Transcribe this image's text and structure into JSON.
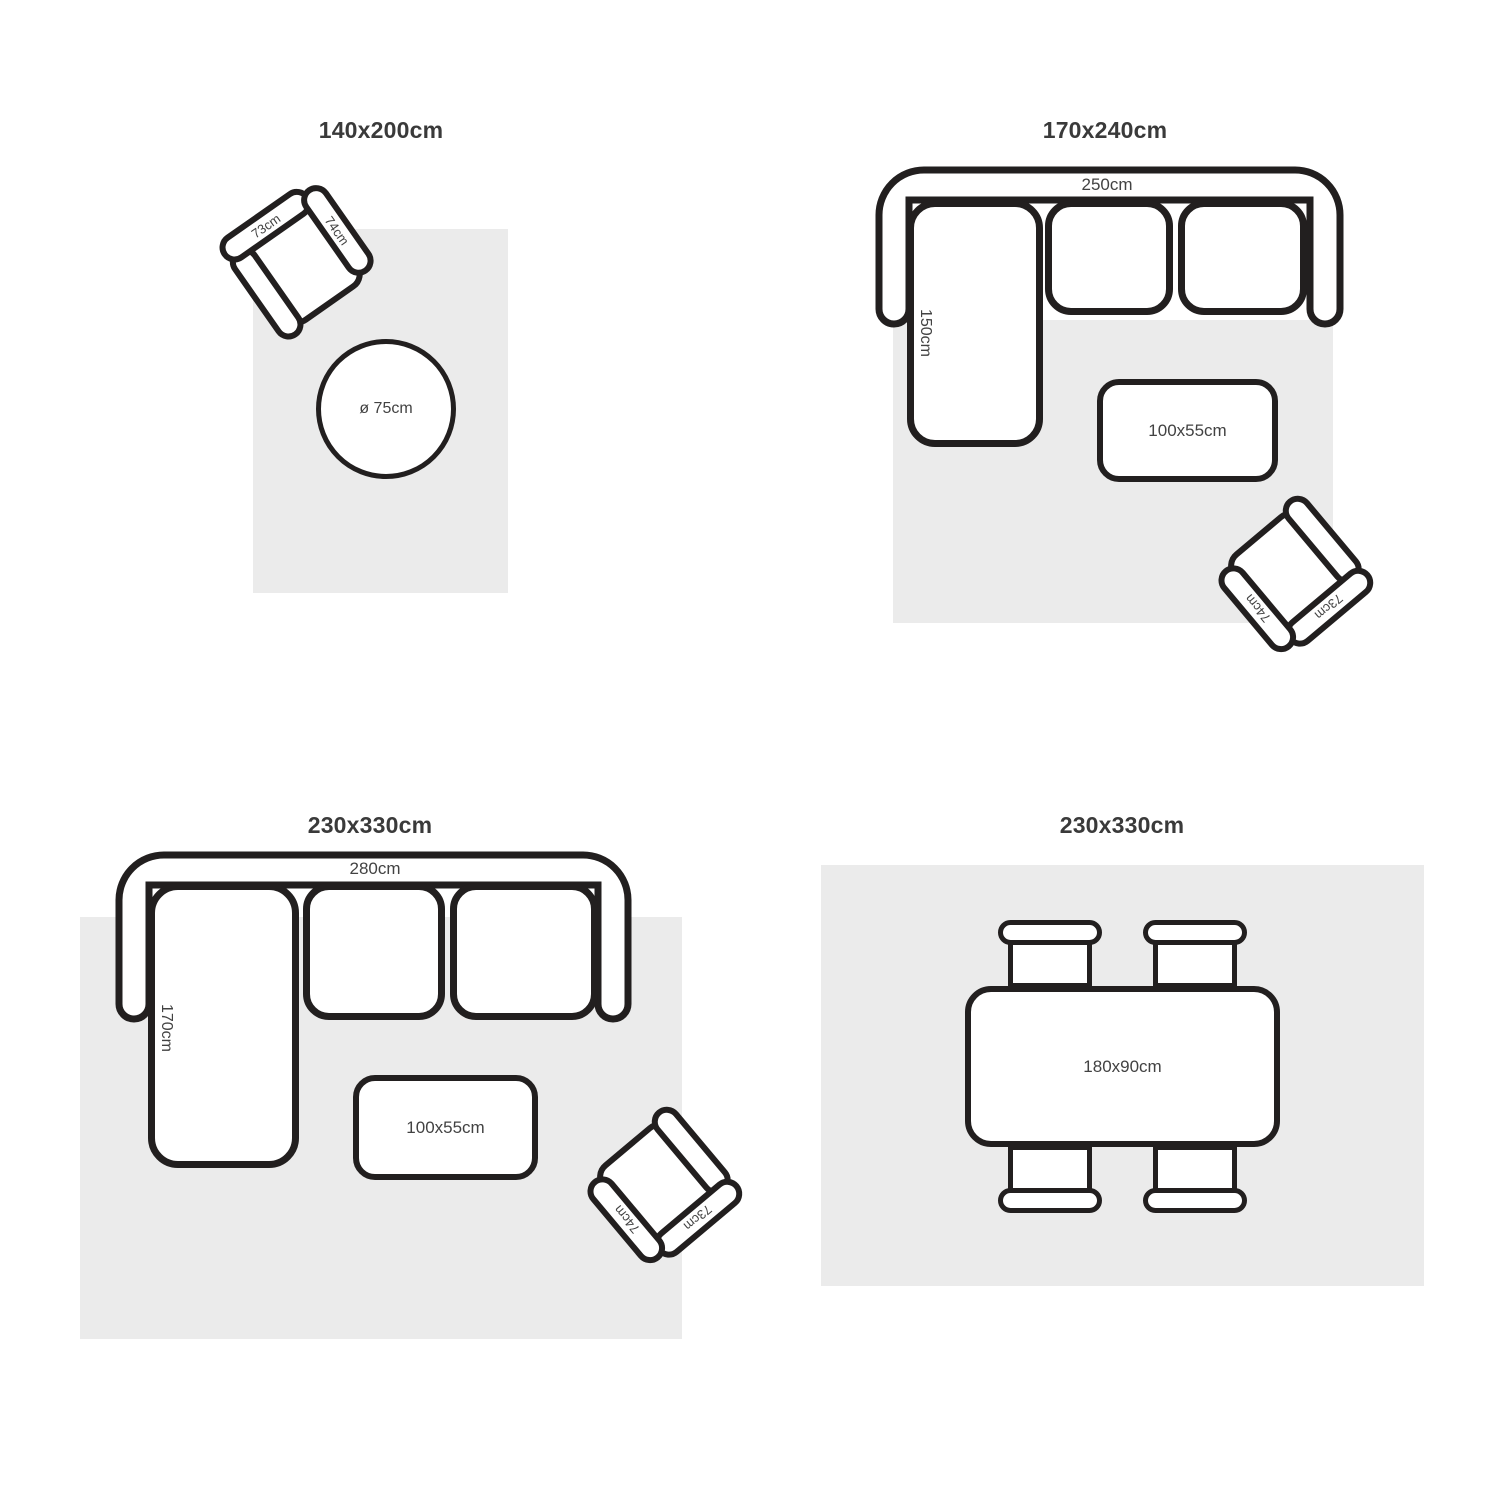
{
  "colors": {
    "background": "#ffffff",
    "rug": "#ebebeb",
    "outline": "#221f1f",
    "title_text": "#3a3a3a",
    "label_text": "#424242"
  },
  "panels": {
    "top_left": {
      "title": "140x200cm",
      "armchair": {
        "back_label": "73cm",
        "arm_label": "74cm"
      },
      "side_table_label": "ø 75cm"
    },
    "top_right": {
      "title": "170x240cm",
      "sofa": {
        "width_label": "250cm",
        "chaise_label": "150cm"
      },
      "coffee_table_label": "100x55cm",
      "armchair": {
        "back_label": "73cm",
        "arm_label": "74cm"
      }
    },
    "bottom_left": {
      "title": "230x330cm",
      "sofa": {
        "width_label": "280cm",
        "chaise_label": "170cm"
      },
      "coffee_table_label": "100x55cm",
      "armchair": {
        "back_label": "73cm",
        "arm_label": "74cm"
      }
    },
    "bottom_right": {
      "title": "230x330cm",
      "dining_table_label": "180x90cm"
    }
  }
}
